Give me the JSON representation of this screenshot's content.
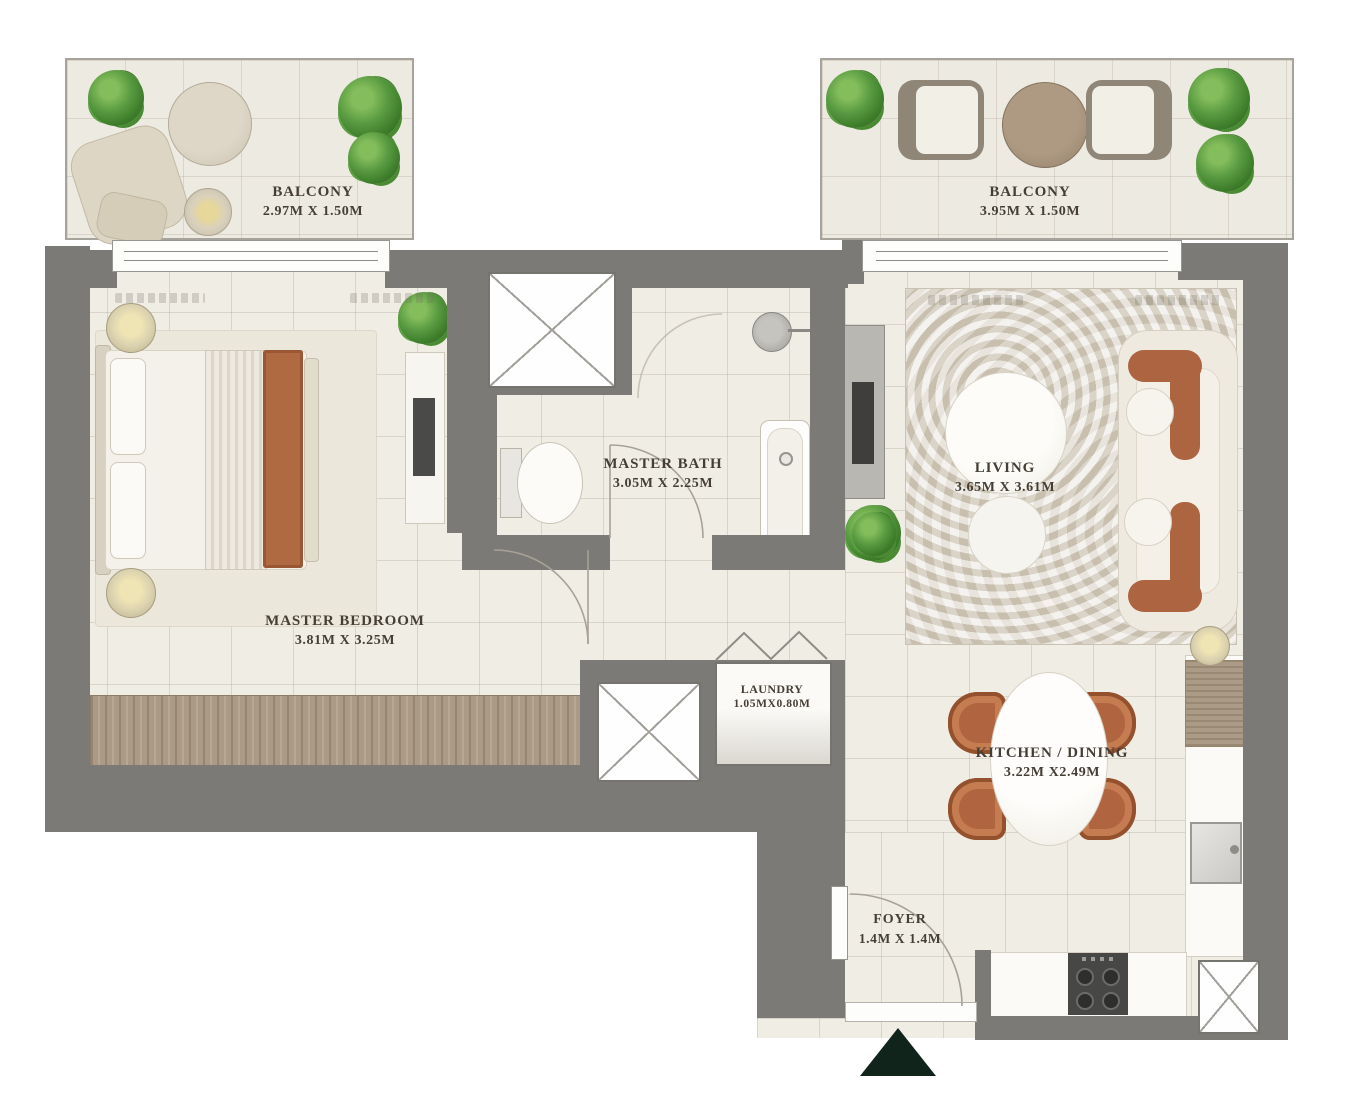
{
  "plan": {
    "title": "Apartment floor plan",
    "rooms": [
      {
        "id": "balcony-left",
        "name": "BALCONY",
        "dims": "2.97M X 1.50M"
      },
      {
        "id": "balcony-right",
        "name": "BALCONY",
        "dims": "3.95M X 1.50M"
      },
      {
        "id": "master-bedroom",
        "name": "MASTER BEDROOM",
        "dims": "3.81M X 3.25M"
      },
      {
        "id": "master-bath",
        "name": "MASTER BATH",
        "dims": "3.05M X 2.25M"
      },
      {
        "id": "living",
        "name": "LIVING",
        "dims": "3.65M X 3.61M"
      },
      {
        "id": "laundry",
        "name": "LAUNDRY",
        "dims": "1.05MX0.80M"
      },
      {
        "id": "kitchen-dining",
        "name": "KITCHEN / DINING",
        "dims": "3.22M X2.49M"
      },
      {
        "id": "foyer",
        "name": "FOYER",
        "dims": "1.4M X 1.4M"
      }
    ],
    "markers": {
      "entrance": "entrance-arrow"
    },
    "colors": {
      "wall": "#7b7a76",
      "floor": "#f0ede5",
      "wood": "#ab9a85",
      "terracotta": "#b06540",
      "rug": "#ddd6c8",
      "plant": "#579940",
      "entrance_arrow": "#10241c",
      "label_text": "#453e35"
    }
  }
}
